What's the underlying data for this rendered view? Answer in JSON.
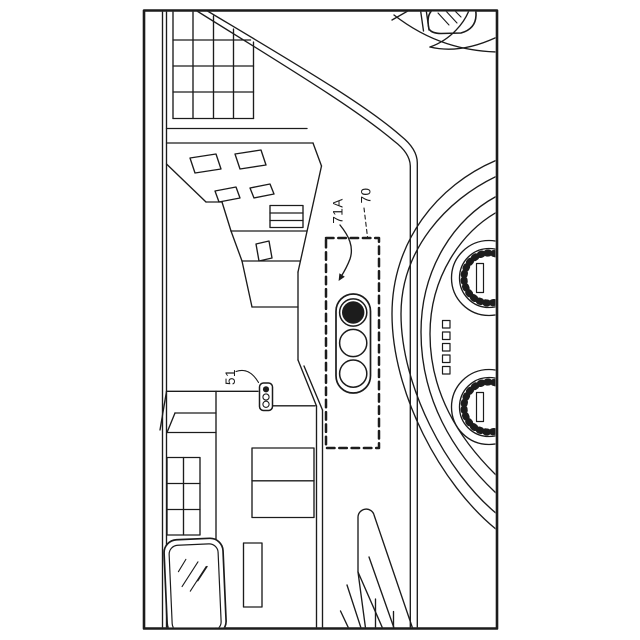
{
  "figure": {
    "type": "patent-line-drawing",
    "description": "rotated vehicle windshield view with HUD traffic-light indicator, instrument gauges and street scene",
    "ink_color": "#1c1c1c",
    "background_color": "#ffffff",
    "labels": {
      "hud_traffic_light": "71A",
      "hud_display_region": "70",
      "roadside_traffic_light": "51"
    }
  }
}
